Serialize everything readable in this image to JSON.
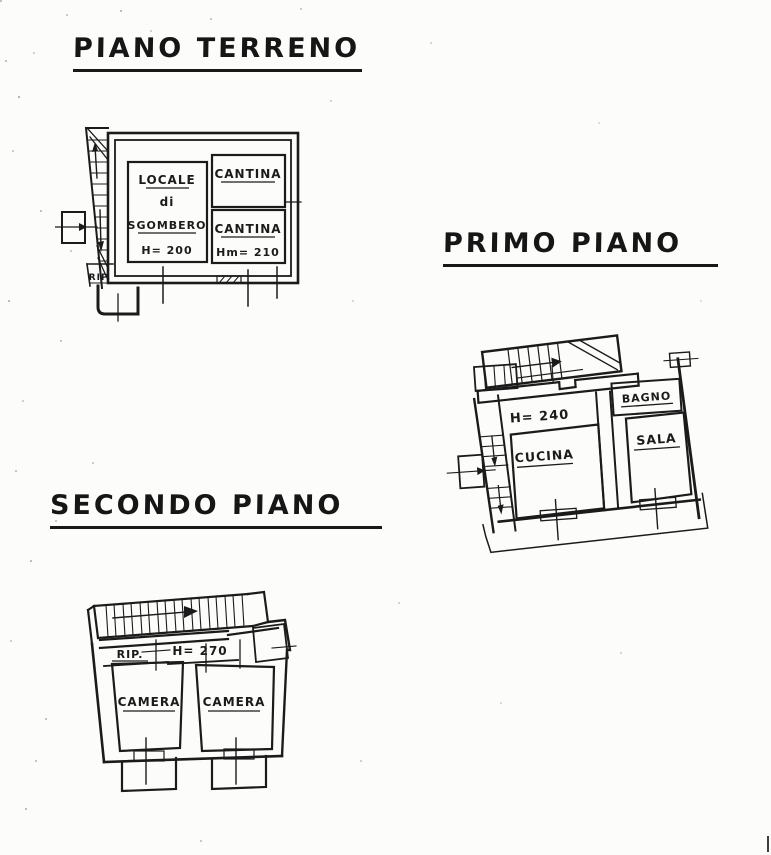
{
  "colors": {
    "ink": "#1b1b1b",
    "paper": "#fcfcfa"
  },
  "floors": {
    "ground": {
      "title": "PIANO TERRENO",
      "rooms": {
        "locale": {
          "line1": "LOCALE",
          "line2": "di",
          "line3": "SGOMBERO",
          "height": "H= 200"
        },
        "cantina_top": {
          "name": "CANTINA"
        },
        "cantina_bottom": {
          "name": "CANTINA",
          "height": "Hm= 210"
        },
        "rip": {
          "name": "RIP."
        }
      }
    },
    "first": {
      "title": "PRIMO PIANO",
      "height": "H= 240",
      "rooms": {
        "bagno": {
          "name": "BAGNO"
        },
        "cucina": {
          "name": "CUCINA"
        },
        "sala": {
          "name": "SALA"
        }
      }
    },
    "second": {
      "title": "SECONDO PIANO",
      "height": "H= 270",
      "rooms": {
        "rip": {
          "name": "RIP."
        },
        "camera_left": {
          "name": "CAMERA"
        },
        "camera_right": {
          "name": "CAMERA"
        }
      }
    }
  }
}
